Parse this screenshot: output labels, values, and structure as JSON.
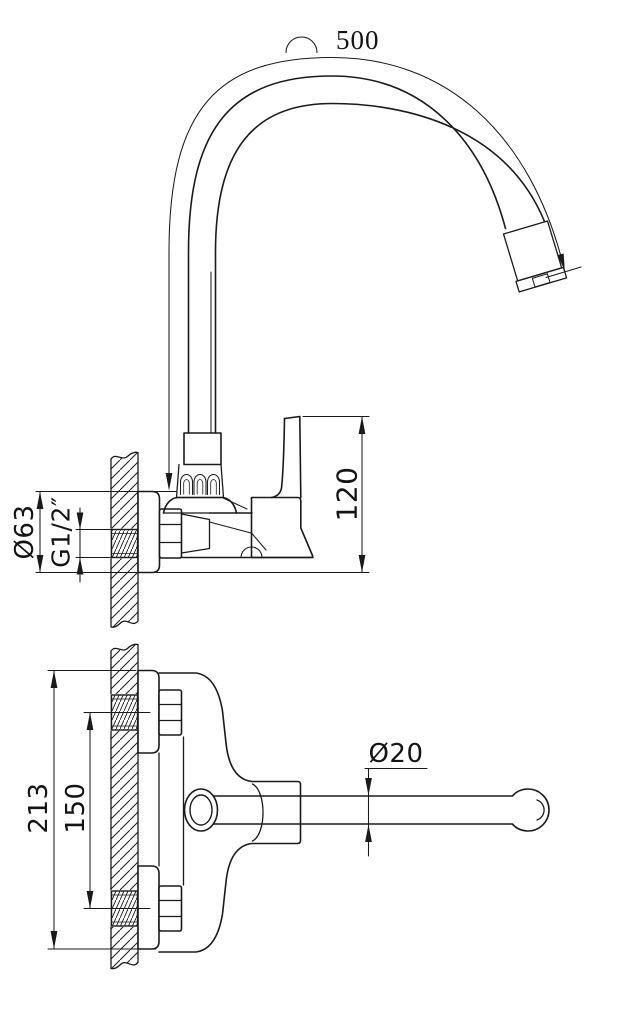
{
  "meta": {
    "title": "Wall-mounted kitchen faucet — technical drawing",
    "drawing_type": "orthographic engineering drawing, front view and plan view",
    "background_color": "#ffffff",
    "line_color": "#1a1a1a"
  },
  "dims": {
    "hose_arc_length": "500",
    "body_height": "120",
    "flange_diameter": "Ø63",
    "inlet_thread": "G1/2″",
    "overall_height": "213",
    "inlet_spacing": "150",
    "spout_tube_diameter": "Ø20"
  }
}
